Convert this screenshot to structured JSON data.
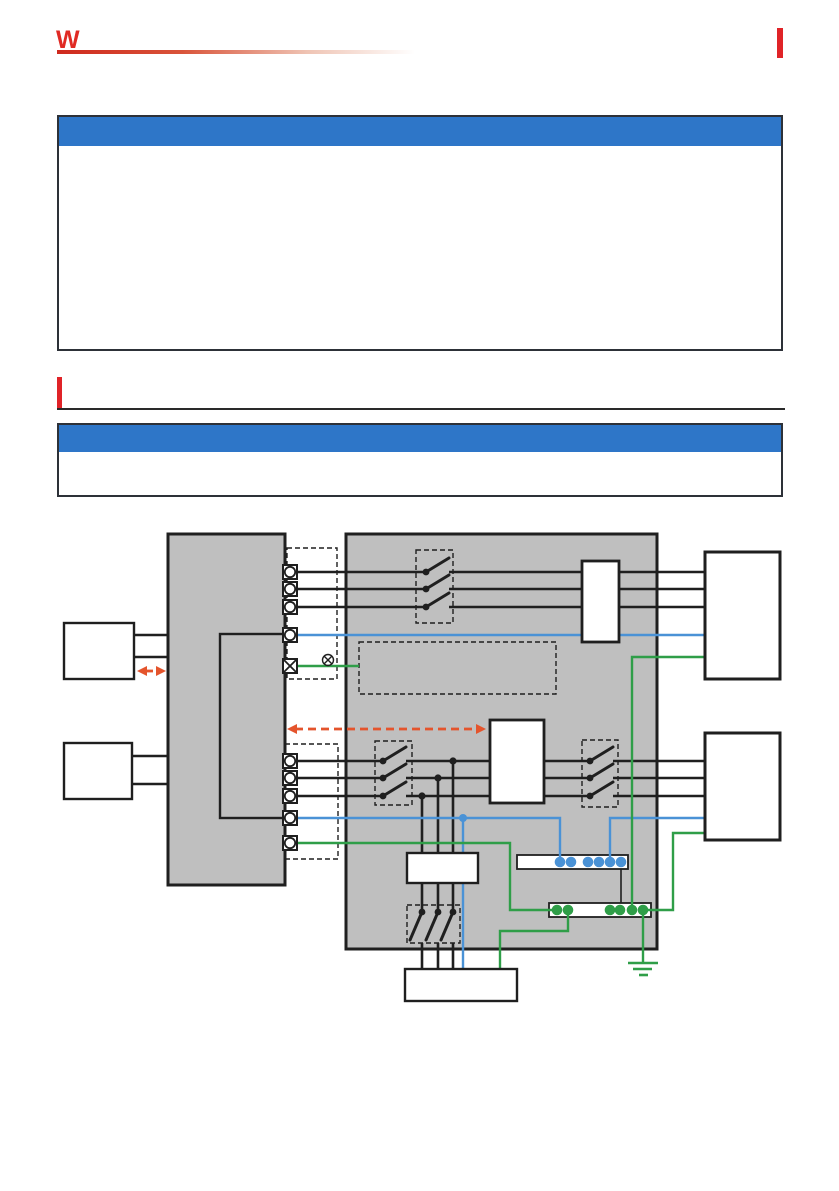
{
  "page": {
    "width": 839,
    "height": 1191,
    "bg": "#ffffff"
  },
  "header": {
    "logo_glyph": "W",
    "logo_color": "#e02a24",
    "rule_color": "#cf291d",
    "edge_tab_color": "#e02328"
  },
  "callouts": [
    {
      "id": "callout-top",
      "title": "",
      "body": "",
      "bar_color": "#2e76c8"
    },
    {
      "id": "callout-connection",
      "title": "",
      "body": "",
      "bar_color": "#2e76c8"
    }
  ],
  "section_heading": {
    "title": "",
    "bar_color": "#e02328"
  },
  "diagram": {
    "colors": {
      "unit_fill": "#bfbfbf",
      "line": "#1f1f1f",
      "blue": "#4a92d6",
      "green": "#2f9e48",
      "orange": "#e4542c",
      "white": "#ffffff"
    },
    "gray_units": [
      {
        "name": "left-measurement-unit",
        "x": 168,
        "y": 534,
        "w": 117,
        "h": 351
      },
      {
        "name": "right-power-unit",
        "x": 346,
        "y": 534,
        "w": 311,
        "h": 415
      }
    ],
    "dashed_rects": [
      {
        "name": "upper-terminal-group-dashed",
        "x": 287,
        "y": 548,
        "w": 50,
        "h": 131
      },
      {
        "name": "lower-terminal-group-dashed",
        "x": 285,
        "y": 744,
        "w": 53,
        "h": 115
      },
      {
        "name": "upper-switch-dashed",
        "x": 416,
        "y": 550,
        "w": 37,
        "h": 73
      },
      {
        "name": "note-area-dashed",
        "x": 359,
        "y": 642,
        "w": 197,
        "h": 52
      },
      {
        "name": "lower-switch-left-dashed",
        "x": 375,
        "y": 741,
        "w": 37,
        "h": 64
      },
      {
        "name": "lower-switch-right-dashed",
        "x": 582,
        "y": 740,
        "w": 36,
        "h": 67
      },
      {
        "name": "bottom-switch-dashed",
        "x": 407,
        "y": 905,
        "w": 53,
        "h": 38
      }
    ],
    "outline_rects": [
      {
        "name": "internal-bus-rect",
        "x": 220,
        "y": 634,
        "w": 65,
        "h": 184
      }
    ],
    "strips": [
      {
        "name": "blue-terminal-strip",
        "x": 517,
        "y": 855,
        "w": 111,
        "h": 14,
        "dot_y": 862,
        "dots": [
          560,
          571,
          588,
          599,
          610,
          621
        ],
        "dot_color": "blue"
      },
      {
        "name": "green-terminal-strip",
        "x": 549,
        "y": 903,
        "w": 102,
        "h": 14,
        "dot_y": 910,
        "dots": [
          557,
          568,
          610,
          620,
          632,
          643
        ],
        "dot_color": "green"
      }
    ],
    "wires": [
      {
        "name": "upper-left-link-a",
        "color": "line",
        "w": 2.4,
        "pts": [
          [
            134,
            635
          ],
          [
            168,
            635
          ]
        ]
      },
      {
        "name": "upper-left-link-b",
        "color": "line",
        "w": 2.4,
        "pts": [
          [
            134,
            657
          ],
          [
            168,
            657
          ]
        ]
      },
      {
        "name": "lower-left-link-a",
        "color": "line",
        "w": 2.4,
        "pts": [
          [
            132,
            756
          ],
          [
            168,
            756
          ]
        ]
      },
      {
        "name": "lower-left-link-b",
        "color": "line",
        "w": 2.4,
        "pts": [
          [
            132,
            784
          ],
          [
            168,
            784
          ]
        ]
      },
      {
        "name": "phase-u1-left",
        "color": "line",
        "w": 2.6,
        "pts": [
          [
            297,
            572
          ],
          [
            426,
            572
          ]
        ]
      },
      {
        "name": "phase-u1-right",
        "color": "line",
        "w": 2.6,
        "pts": [
          [
            449,
            572
          ],
          [
            705,
            572
          ]
        ]
      },
      {
        "name": "phase-u2-left",
        "color": "line",
        "w": 2.6,
        "pts": [
          [
            297,
            589
          ],
          [
            426,
            589
          ]
        ]
      },
      {
        "name": "phase-u2-right",
        "color": "line",
        "w": 2.6,
        "pts": [
          [
            449,
            589
          ],
          [
            705,
            589
          ]
        ]
      },
      {
        "name": "phase-u3-left",
        "color": "line",
        "w": 2.6,
        "pts": [
          [
            297,
            607
          ],
          [
            426,
            607
          ]
        ]
      },
      {
        "name": "phase-u3-right",
        "color": "line",
        "w": 2.6,
        "pts": [
          [
            449,
            607
          ],
          [
            705,
            607
          ]
        ]
      },
      {
        "name": "phase-l1-left",
        "color": "line",
        "w": 2.6,
        "pts": [
          [
            297,
            761
          ],
          [
            383,
            761
          ]
        ]
      },
      {
        "name": "phase-l1-mid",
        "color": "line",
        "w": 2.6,
        "pts": [
          [
            406,
            761
          ],
          [
            590,
            761
          ]
        ]
      },
      {
        "name": "phase-l1-right",
        "color": "line",
        "w": 2.6,
        "pts": [
          [
            613,
            761
          ],
          [
            705,
            761
          ]
        ]
      },
      {
        "name": "phase-l2-left",
        "color": "line",
        "w": 2.6,
        "pts": [
          [
            297,
            778
          ],
          [
            383,
            778
          ]
        ]
      },
      {
        "name": "phase-l2-mid",
        "color": "line",
        "w": 2.6,
        "pts": [
          [
            406,
            778
          ],
          [
            590,
            778
          ]
        ]
      },
      {
        "name": "phase-l2-right",
        "color": "line",
        "w": 2.6,
        "pts": [
          [
            613,
            778
          ],
          [
            705,
            778
          ]
        ]
      },
      {
        "name": "phase-l3-left",
        "color": "line",
        "w": 2.6,
        "pts": [
          [
            297,
            796
          ],
          [
            383,
            796
          ]
        ]
      },
      {
        "name": "phase-l3-mid",
        "color": "line",
        "w": 2.6,
        "pts": [
          [
            406,
            796
          ],
          [
            590,
            796
          ]
        ]
      },
      {
        "name": "phase-l3-right",
        "color": "line",
        "w": 2.6,
        "pts": [
          [
            613,
            796
          ],
          [
            705,
            796
          ]
        ]
      },
      {
        "name": "tap-a-upper",
        "color": "line",
        "w": 2.6,
        "pts": [
          [
            453,
            761
          ],
          [
            453,
            912
          ]
        ]
      },
      {
        "name": "tap-b-upper",
        "color": "line",
        "w": 2.6,
        "pts": [
          [
            438,
            778
          ],
          [
            438,
            912
          ]
        ]
      },
      {
        "name": "tap-c-upper",
        "color": "line",
        "w": 2.6,
        "pts": [
          [
            422,
            796
          ],
          [
            422,
            912
          ]
        ]
      },
      {
        "name": "tap-a-lower",
        "color": "line",
        "w": 2.6,
        "pts": [
          [
            453,
            943
          ],
          [
            453,
            969
          ]
        ]
      },
      {
        "name": "tap-b-lower",
        "color": "line",
        "w": 2.6,
        "pts": [
          [
            438,
            943
          ],
          [
            438,
            969
          ]
        ]
      },
      {
        "name": "tap-c-lower",
        "color": "line",
        "w": 2.6,
        "pts": [
          [
            422,
            943
          ],
          [
            422,
            969
          ]
        ]
      },
      {
        "name": "strip-link",
        "color": "line",
        "w": 1.6,
        "pts": [
          [
            621,
            869
          ],
          [
            621,
            903
          ]
        ]
      },
      {
        "name": "sense-blue-upper",
        "color": "blue",
        "w": 2.4,
        "pts": [
          [
            297,
            635
          ],
          [
            705,
            635
          ]
        ]
      },
      {
        "name": "sense-blue-lower",
        "color": "blue",
        "w": 2.4,
        "pts": [
          [
            297,
            818
          ],
          [
            560,
            818
          ],
          [
            560,
            862
          ]
        ]
      },
      {
        "name": "blue-branch-vertical",
        "color": "blue",
        "w": 2.4,
        "pts": [
          [
            463,
            818
          ],
          [
            463,
            969
          ]
        ]
      },
      {
        "name": "blue-right-link",
        "color": "blue",
        "w": 2.4,
        "pts": [
          [
            705,
            818
          ],
          [
            610,
            818
          ],
          [
            610,
            862
          ]
        ]
      },
      {
        "name": "green-terminal-stub",
        "color": "green",
        "w": 2.4,
        "pts": [
          [
            297,
            666
          ],
          [
            359,
            666
          ]
        ]
      },
      {
        "name": "pe-upper-right",
        "color": "green",
        "w": 2.4,
        "pts": [
          [
            705,
            657
          ],
          [
            632,
            657
          ],
          [
            632,
            910
          ]
        ]
      },
      {
        "name": "pe-left-run",
        "color": "green",
        "w": 2.4,
        "pts": [
          [
            297,
            843
          ],
          [
            510,
            843
          ],
          [
            510,
            910
          ],
          [
            557,
            910
          ]
        ]
      },
      {
        "name": "pe-lower-right",
        "color": "green",
        "w": 2.4,
        "pts": [
          [
            705,
            833
          ],
          [
            673,
            833
          ],
          [
            673,
            910
          ],
          [
            643,
            910
          ]
        ]
      },
      {
        "name": "pe-to-bottom-device",
        "color": "green",
        "w": 2.4,
        "pts": [
          [
            568,
            910
          ],
          [
            568,
            931
          ],
          [
            500,
            931
          ],
          [
            500,
            969
          ]
        ]
      },
      {
        "name": "pe-ground-drop",
        "color": "green",
        "w": 2.4,
        "pts": [
          [
            643,
            910
          ],
          [
            643,
            962
          ]
        ]
      }
    ],
    "switches": [
      {
        "name": "switch-u1",
        "dot": [
          426,
          572
        ],
        "tip": [
          449,
          558
        ]
      },
      {
        "name": "switch-u2",
        "dot": [
          426,
          589
        ],
        "tip": [
          449,
          575
        ]
      },
      {
        "name": "switch-u3",
        "dot": [
          426,
          607
        ],
        "tip": [
          449,
          593
        ]
      },
      {
        "name": "switch-l1-left",
        "dot": [
          383,
          761
        ],
        "tip": [
          406,
          747
        ]
      },
      {
        "name": "switch-l2-left",
        "dot": [
          383,
          778
        ],
        "tip": [
          406,
          764
        ]
      },
      {
        "name": "switch-l3-left",
        "dot": [
          383,
          796
        ],
        "tip": [
          406,
          782
        ]
      },
      {
        "name": "switch-l1-right",
        "dot": [
          590,
          761
        ],
        "tip": [
          613,
          747
        ]
      },
      {
        "name": "switch-l2-right",
        "dot": [
          590,
          778
        ],
        "tip": [
          613,
          764
        ]
      },
      {
        "name": "switch-l3-right",
        "dot": [
          590,
          796
        ],
        "tip": [
          613,
          782
        ]
      },
      {
        "name": "switch-b1",
        "dot": [
          422,
          912
        ],
        "tip": [
          410,
          940
        ]
      },
      {
        "name": "switch-b2",
        "dot": [
          438,
          912
        ],
        "tip": [
          426,
          940
        ]
      },
      {
        "name": "switch-b3",
        "dot": [
          453,
          912
        ],
        "tip": [
          441,
          940
        ]
      }
    ],
    "junction_dots": [
      {
        "name": "junction-tap-a",
        "x": 453,
        "y": 761,
        "r": 3.6,
        "color": "line"
      },
      {
        "name": "junction-tap-b",
        "x": 438,
        "y": 778,
        "r": 3.6,
        "color": "line"
      },
      {
        "name": "junction-tap-c",
        "x": 422,
        "y": 796,
        "r": 3.6,
        "color": "line"
      },
      {
        "name": "junction-blue",
        "x": 463,
        "y": 818,
        "r": 4,
        "color": "blue"
      }
    ],
    "white_boxes": [
      {
        "name": "upper-left-device",
        "x": 64,
        "y": 623,
        "w": 70,
        "h": 56,
        "sw": 2.4
      },
      {
        "name": "lower-left-device",
        "x": 64,
        "y": 743,
        "w": 68,
        "h": 56,
        "sw": 2.4
      },
      {
        "name": "upper-inline-module",
        "x": 582,
        "y": 561,
        "w": 37,
        "h": 81,
        "sw": 2.8
      },
      {
        "name": "middle-module",
        "x": 490,
        "y": 720,
        "w": 54,
        "h": 83,
        "sw": 2.8
      },
      {
        "name": "breaker-box",
        "x": 407,
        "y": 853,
        "w": 71,
        "h": 30,
        "sw": 2.4
      },
      {
        "name": "bottom-device",
        "x": 405,
        "y": 969,
        "w": 112,
        "h": 32,
        "sw": 2.4
      },
      {
        "name": "upper-right-device",
        "x": 705,
        "y": 552,
        "w": 75,
        "h": 127,
        "sw": 3
      },
      {
        "name": "lower-right-device",
        "x": 705,
        "y": 733,
        "w": 75,
        "h": 107,
        "sw": 3
      }
    ],
    "terminals": [
      {
        "name": "terminal-u1",
        "x": 290,
        "y": 572,
        "type": "circle"
      },
      {
        "name": "terminal-u2",
        "x": 290,
        "y": 589,
        "type": "circle"
      },
      {
        "name": "terminal-u3",
        "x": 290,
        "y": 607,
        "type": "circle"
      },
      {
        "name": "terminal-u-blue",
        "x": 290,
        "y": 635,
        "type": "circle"
      },
      {
        "name": "terminal-u-ground",
        "x": 290,
        "y": 666,
        "type": "cross"
      },
      {
        "name": "terminal-l1",
        "x": 290,
        "y": 761,
        "type": "circle"
      },
      {
        "name": "terminal-l2",
        "x": 290,
        "y": 778,
        "type": "circle"
      },
      {
        "name": "terminal-l3",
        "x": 290,
        "y": 796,
        "type": "circle"
      },
      {
        "name": "terminal-l-blue",
        "x": 290,
        "y": 818,
        "type": "circle"
      },
      {
        "name": "terminal-l-green",
        "x": 290,
        "y": 843,
        "type": "circle"
      }
    ],
    "annotations": [
      {
        "name": "crossed-circle-symbol",
        "x": 328,
        "y": 660,
        "r": 5.5
      }
    ],
    "arrows": [
      {
        "name": "interface-arrow-left",
        "x1": 137,
        "y1": 671,
        "x2": 166,
        "y2": 671
      },
      {
        "name": "interface-arrow-middle",
        "x1": 287,
        "y1": 729,
        "x2": 486,
        "y2": 729
      }
    ],
    "ground": {
      "name": "earth-ground-symbol",
      "lines": [
        [
          628,
          658,
          963
        ],
        [
          633,
          652,
          969
        ],
        [
          639,
          648,
          975
        ]
      ]
    }
  }
}
